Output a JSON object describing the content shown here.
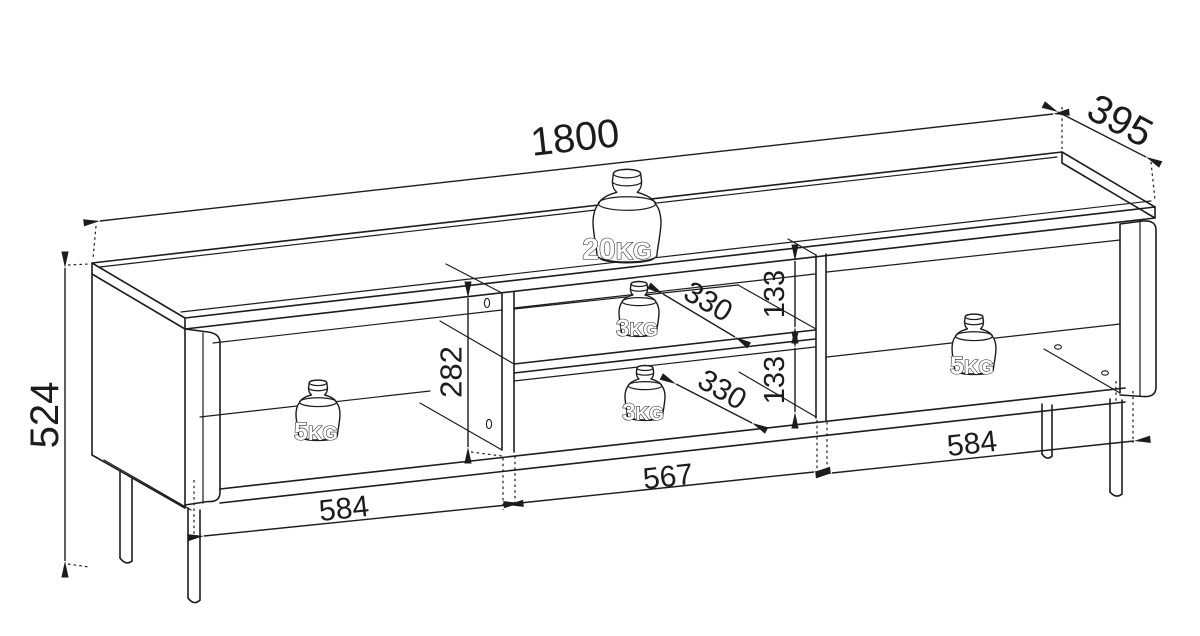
{
  "title": "TV stand technical dimension drawing",
  "colors": {
    "line": "#1c1c1c",
    "background": "#ffffff"
  },
  "dims": {
    "total_width": "1800",
    "total_depth": "395",
    "total_height": "524",
    "interior_height": "282",
    "upper_shelf_gap": "133",
    "lower_shelf_gap": "133",
    "upper_shelf_depth": "330",
    "lower_shelf_depth": "330",
    "middle_niche_width": "567",
    "left_compartment_width": "584",
    "right_compartment_width": "584"
  },
  "loads": {
    "top": {
      "value": "20",
      "unit": "KG"
    },
    "upper_shelf": {
      "value": "3",
      "unit": "KG"
    },
    "lower_shelf": {
      "value": "3",
      "unit": "KG"
    },
    "left_compartment": {
      "value": "5",
      "unit": "KG"
    },
    "right_compartment": {
      "value": "5",
      "unit": "KG"
    }
  }
}
